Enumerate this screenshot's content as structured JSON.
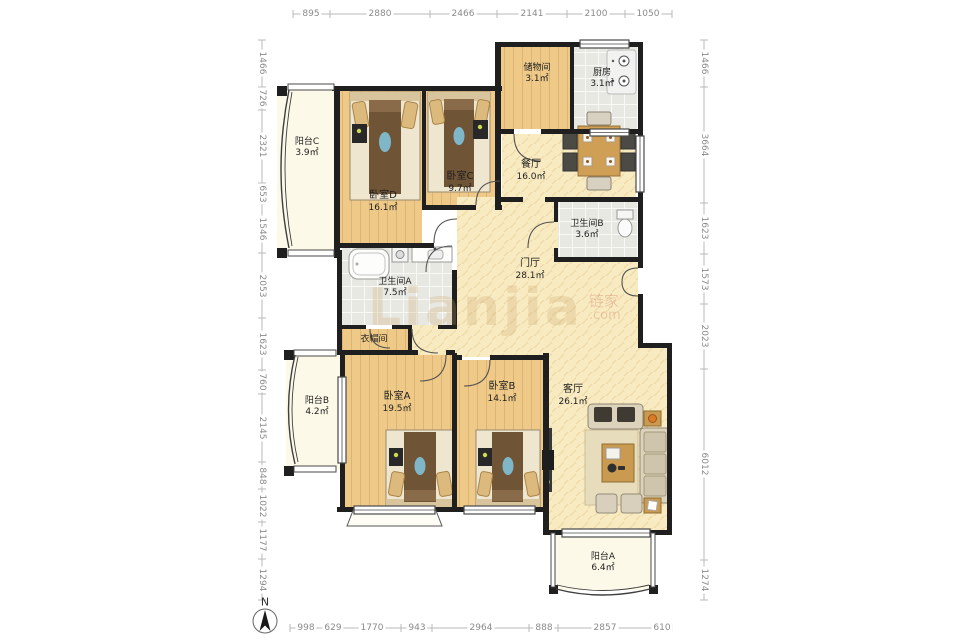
{
  "watermark": {
    "main": "Lianjia",
    "cn": "链家",
    "com": ".com"
  },
  "compass": {
    "label": "N"
  },
  "dimensions": {
    "top": [
      "895",
      "2880",
      "2466",
      "2141",
      "2100",
      "1050"
    ],
    "bottom": [
      "998",
      "629",
      "1770",
      "943",
      "2964",
      "888",
      "2857",
      "610"
    ],
    "left": [
      "1466",
      "726",
      "2321",
      "653",
      "1546",
      "2053",
      "1623",
      "760",
      "2145",
      "848",
      "1022",
      "1177",
      "1294"
    ],
    "right": [
      "1466",
      "3664",
      "1623",
      "1573",
      "2023",
      "6012",
      "1274"
    ]
  },
  "rooms": [
    {
      "id": "balcony-c",
      "name": "阳台C",
      "area": "3.9㎡"
    },
    {
      "id": "bedroom-d",
      "name": "卧室D",
      "area": "16.1㎡"
    },
    {
      "id": "bedroom-c",
      "name": "卧室C",
      "area": "9.7㎡"
    },
    {
      "id": "storage",
      "name": "储物间",
      "area": "3.1㎡"
    },
    {
      "id": "kitchen",
      "name": "厨房",
      "area": "3.1㎡"
    },
    {
      "id": "dining",
      "name": "餐厅",
      "area": "16.0㎡"
    },
    {
      "id": "bathroom-b",
      "name": "卫生间B",
      "area": "3.6㎡"
    },
    {
      "id": "foyer",
      "name": "门厅",
      "area": "28.1㎡"
    },
    {
      "id": "bathroom-a",
      "name": "卫生间A",
      "area": "7.5㎡"
    },
    {
      "id": "cloakroom",
      "name": "衣帽间",
      "area": ""
    },
    {
      "id": "balcony-b",
      "name": "阳台B",
      "area": "4.2㎡"
    },
    {
      "id": "bedroom-a",
      "name": "卧室A",
      "area": "19.5㎡"
    },
    {
      "id": "bedroom-b",
      "name": "卧室B",
      "area": "14.1㎡"
    },
    {
      "id": "living",
      "name": "客厅",
      "area": "26.1㎡"
    },
    {
      "id": "balcony-a",
      "name": "阳台A",
      "area": "6.4㎡"
    }
  ],
  "colors": {
    "wall": "#1f1f1f",
    "wood_floor": "#eec987",
    "open_floor": "#f8ebc2",
    "tile_floor": "#e8e8e2",
    "balcony_floor": "#fcf9e8",
    "dim_text": "#8a8a8a",
    "accent_teal": "#7fb7c8",
    "accent_brown": "#6f5436"
  }
}
